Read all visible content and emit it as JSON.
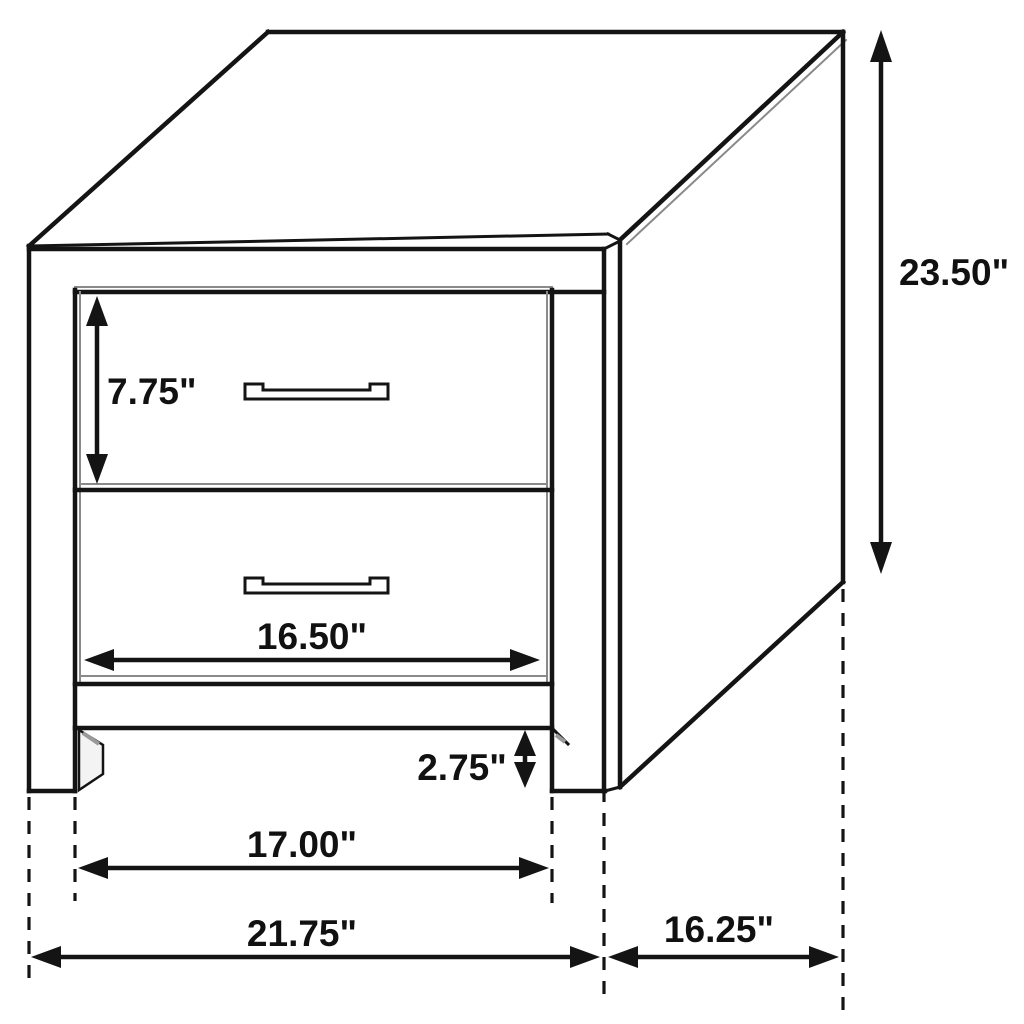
{
  "figure": {
    "type": "furniture-dimension-diagram",
    "subject": "two-drawer nightstand line drawing, three-quarter view",
    "units": "inches",
    "colors": {
      "background": "#ffffff",
      "line": "#141414",
      "text": "#111111"
    },
    "dimensions": {
      "height": "23.50\"",
      "drawer_height": "7.75\"",
      "drawer_width": "16.50\"",
      "base_clearance": "2.75\"",
      "leg_span": "17.00\"",
      "overall_width": "21.75\"",
      "depth": "16.25\""
    }
  }
}
